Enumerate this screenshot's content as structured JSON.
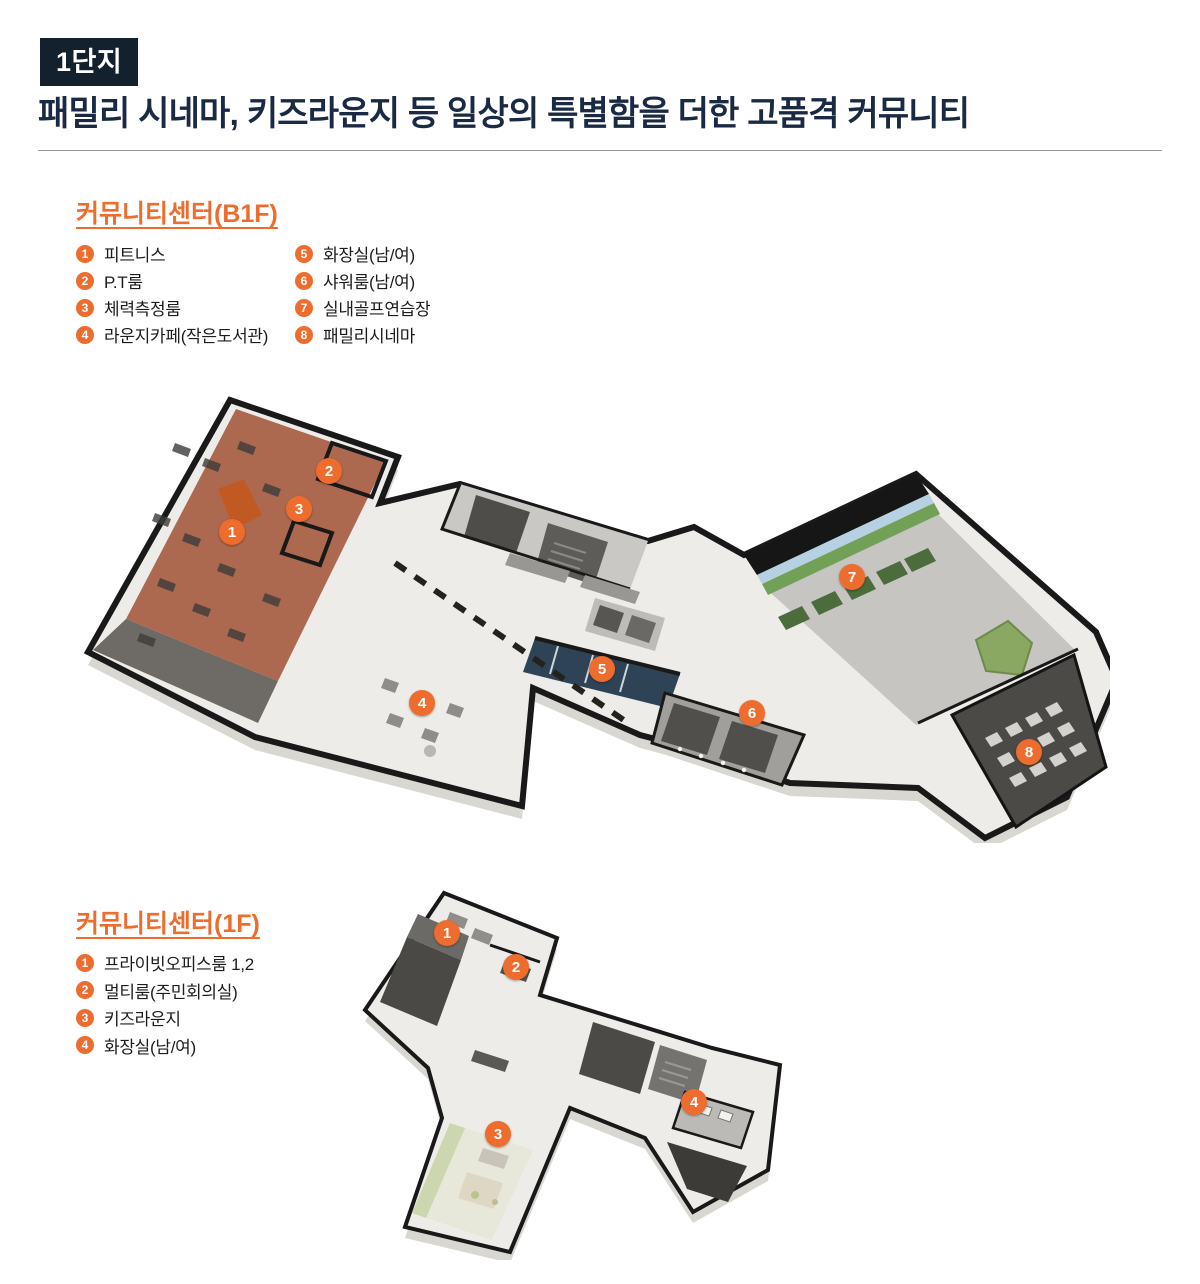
{
  "header": {
    "badge": "1단지",
    "title": "패밀리 시네마, 키즈라운지 등 일상의 특별함을 더한 고품격 커뮤니티"
  },
  "colors": {
    "accent_orange": "#EE6C2D",
    "title_navy": "#1B2A44",
    "badge_bg": "#13202E"
  },
  "b1f": {
    "heading": "커뮤니티센터(B1F)",
    "legend": [
      {
        "num": "1",
        "label": "피트니스"
      },
      {
        "num": "2",
        "label": "P.T룸"
      },
      {
        "num": "3",
        "label": "체력측정룸"
      },
      {
        "num": "4",
        "label": "라운지카페(작은도서관)"
      },
      {
        "num": "5",
        "label": "화장실(남/여)"
      },
      {
        "num": "6",
        "label": "샤워룸(남/여)"
      },
      {
        "num": "7",
        "label": "실내골프연습장"
      },
      {
        "num": "8",
        "label": "패밀리시네마"
      }
    ],
    "markers": [
      {
        "num": "1",
        "x": 152,
        "y": 139
      },
      {
        "num": "2",
        "x": 249,
        "y": 78
      },
      {
        "num": "3",
        "x": 219,
        "y": 116
      },
      {
        "num": "4",
        "x": 342,
        "y": 310
      },
      {
        "num": "5",
        "x": 522,
        "y": 276
      },
      {
        "num": "6",
        "x": 672,
        "y": 320
      },
      {
        "num": "7",
        "x": 772,
        "y": 184
      },
      {
        "num": "8",
        "x": 949,
        "y": 359
      }
    ]
  },
  "f1": {
    "heading": "커뮤니티센터(1F)",
    "legend": [
      {
        "num": "1",
        "label": "프라이빗오피스룸 1,2"
      },
      {
        "num": "2",
        "label": "멀티룸(주민회의실)"
      },
      {
        "num": "3",
        "label": "키즈라운지"
      },
      {
        "num": "4",
        "label": "화장실(남/여)"
      }
    ],
    "markers": [
      {
        "num": "1",
        "x": 92,
        "y": 53
      },
      {
        "num": "2",
        "x": 161,
        "y": 87
      },
      {
        "num": "3",
        "x": 143,
        "y": 254
      },
      {
        "num": "4",
        "x": 339,
        "y": 222
      }
    ]
  }
}
